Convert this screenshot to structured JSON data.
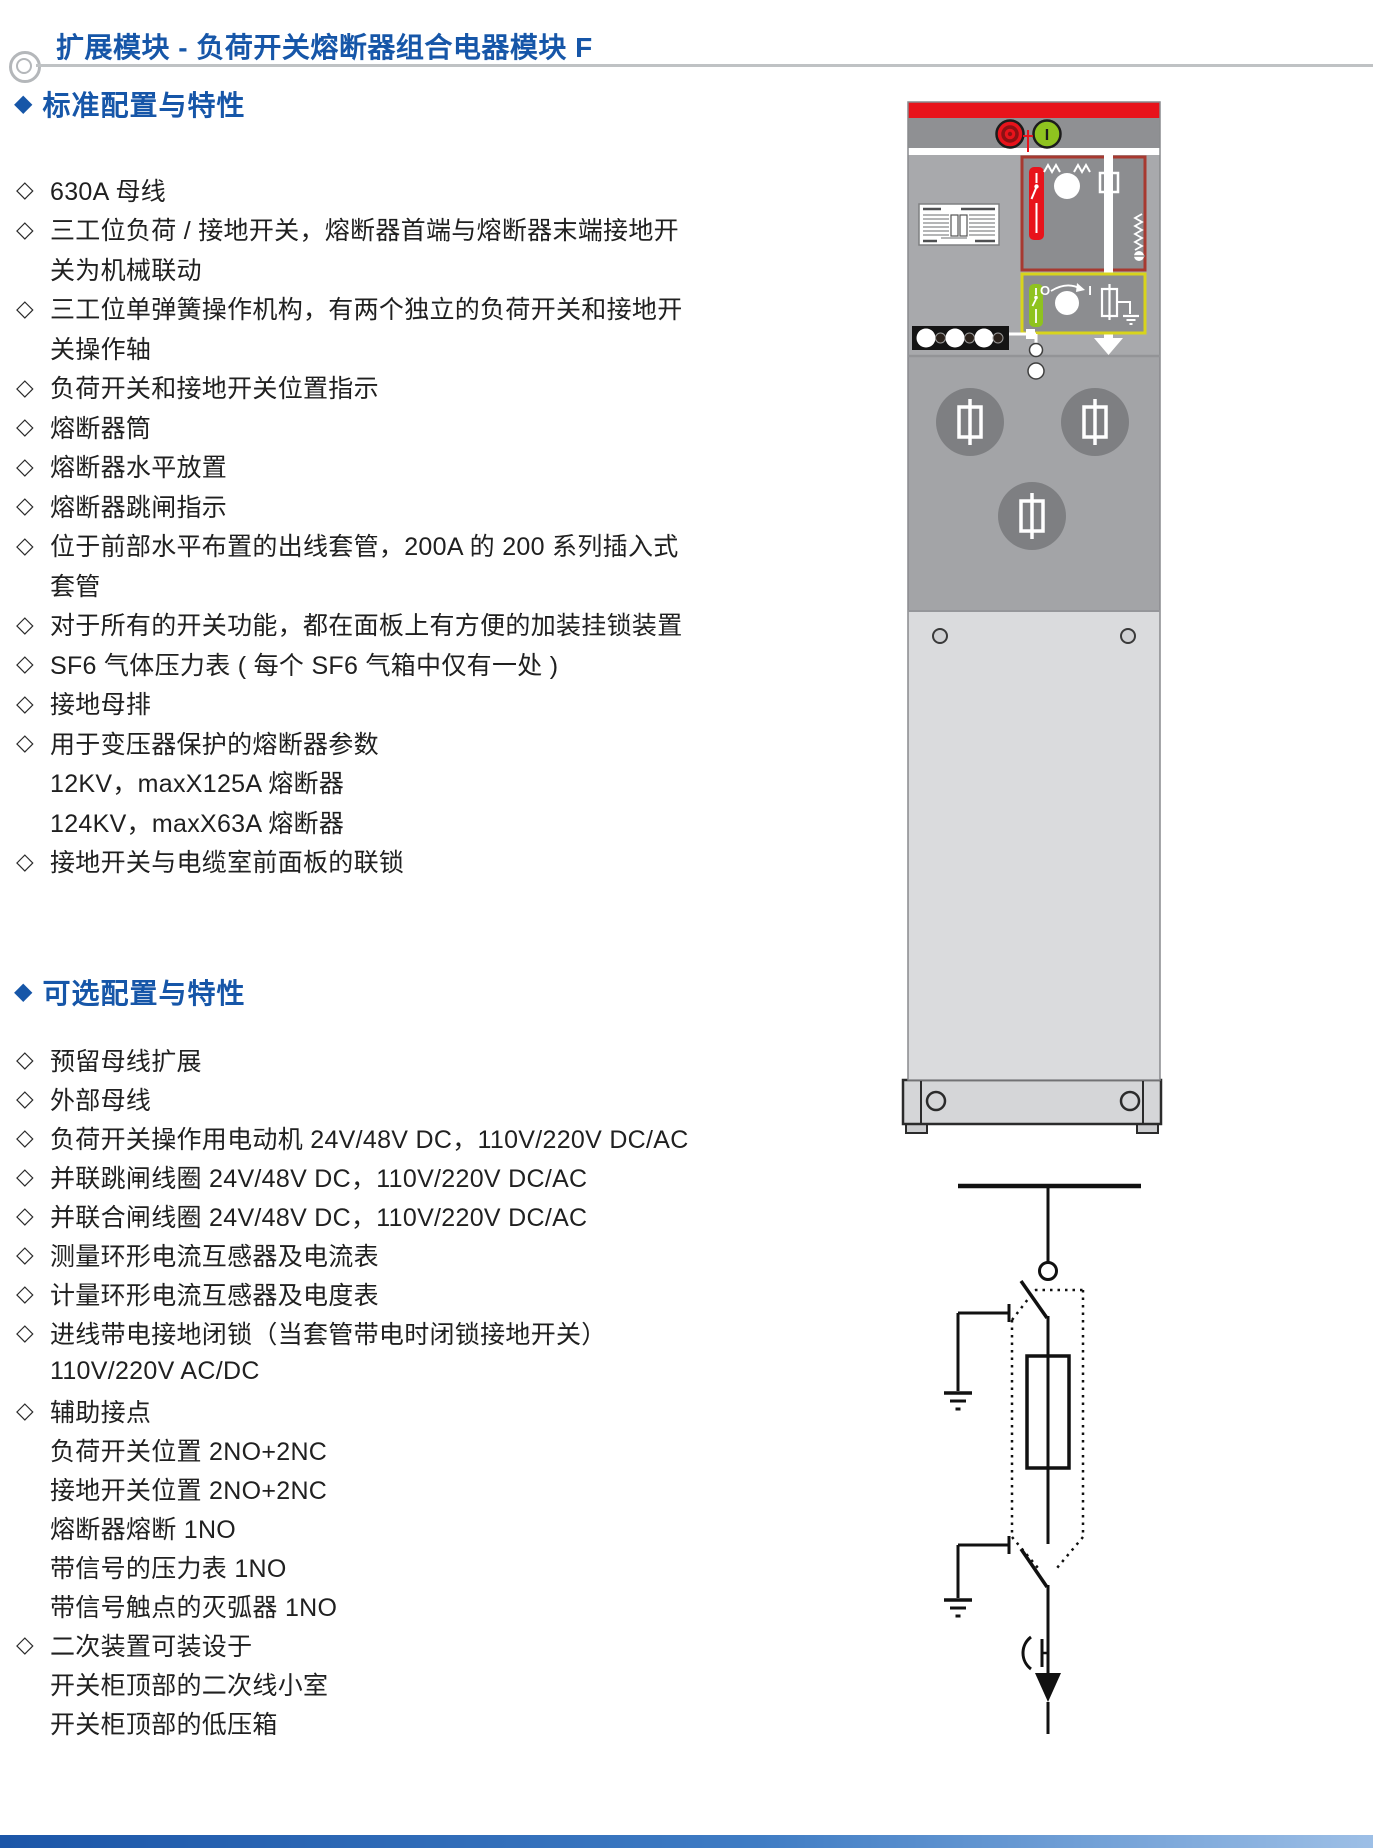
{
  "page": {
    "title": "扩展模块 - 负荷开关熔断器组合电器模块 F",
    "accent_color": "#1656a8"
  },
  "sections": [
    {
      "marker": "◆",
      "heading": "标准配置与特性",
      "lines": [
        {
          "b": "◇",
          "t": "630A 母线"
        },
        {
          "b": "◇",
          "t": "三工位负荷 / 接地开关，熔断器首端与熔断器末端接地开"
        },
        {
          "b": "",
          "t": "关为机械联动"
        },
        {
          "b": "◇",
          "t": "三工位单弹簧操作机构，有两个独立的负荷开关和接地开"
        },
        {
          "b": "",
          "t": "关操作轴"
        },
        {
          "b": "◇",
          "t": "负荷开关和接地开关位置指示"
        },
        {
          "b": "◇",
          "t": "熔断器筒"
        },
        {
          "b": "◇",
          "t": "熔断器水平放置"
        },
        {
          "b": "◇",
          "t": "熔断器跳闸指示"
        },
        {
          "b": "◇",
          "t": "位于前部水平布置的出线套管，200A 的 200 系列插入式"
        },
        {
          "b": "",
          "t": "套管"
        },
        {
          "b": "◇",
          "t": "对于所有的开关功能，都在面板上有方便的加装挂锁装置"
        },
        {
          "b": "◇",
          "t": "SF6 气体压力表 ( 每个 SF6 气箱中仅有一处 )"
        },
        {
          "b": "◇",
          "t": "接地母排"
        },
        {
          "b": "◇",
          "t": "用于变压器保护的熔断器参数"
        },
        {
          "b": "",
          "t": "12KV，maxX125A 熔断器"
        },
        {
          "b": "",
          "t": "124KV，maxX63A 熔断器"
        },
        {
          "b": "◇",
          "t": "接地开关与电缆室前面板的联锁"
        }
      ]
    },
    {
      "marker": "◆",
      "heading": "可选配置与特性",
      "lines": [
        {
          "b": "◇",
          "t": "预留母线扩展"
        },
        {
          "b": "◇",
          "t": "外部母线"
        },
        {
          "b": "◇",
          "t": "负荷开关操作用电动机 24V/48V DC，110V/220V DC/AC"
        },
        {
          "b": "◇",
          "t": "并联跳闸线圈 24V/48V DC，110V/220V DC/AC"
        },
        {
          "b": "◇",
          "t": "并联合闸线圈 24V/48V DC，110V/220V DC/AC"
        },
        {
          "b": "◇",
          "t": "测量环形电流互感器及电流表"
        },
        {
          "b": "◇",
          "t": "计量环形电流互感器及电度表"
        },
        {
          "b": "◇",
          "t": "进线带电接地闭锁（当套管带电时闭锁接地开关）"
        },
        {
          "b": "",
          "t": "110V/220V AC/DC"
        },
        {
          "b": "◇",
          "t": "辅助接点"
        },
        {
          "b": "",
          "t": "负荷开关位置 2NO+2NC"
        },
        {
          "b": "",
          "t": "接地开关位置 2NO+2NC"
        },
        {
          "b": "",
          "t": "熔断器熔断 1NO"
        },
        {
          "b": "",
          "t": "带信号的压力表 1NO"
        },
        {
          "b": "",
          "t": "带信号触点的灭弧器 1NO"
        },
        {
          "b": "◇",
          "t": "二次装置可装设于"
        },
        {
          "b": "",
          "t": "开关柜顶部的二次线小室"
        },
        {
          "b": "",
          "t": "开关柜顶部的低压箱"
        }
      ]
    }
  ],
  "figure": {
    "green_button_label": "I",
    "mimic_open_label": "O",
    "mimic_close_label": "I",
    "colors": {
      "cabinet_red": "#e8131b",
      "mimic_green": "#8fc31f",
      "mimic_yellow_frame": "#d8d41c",
      "mimic_red_frame": "#a73930"
    }
  }
}
